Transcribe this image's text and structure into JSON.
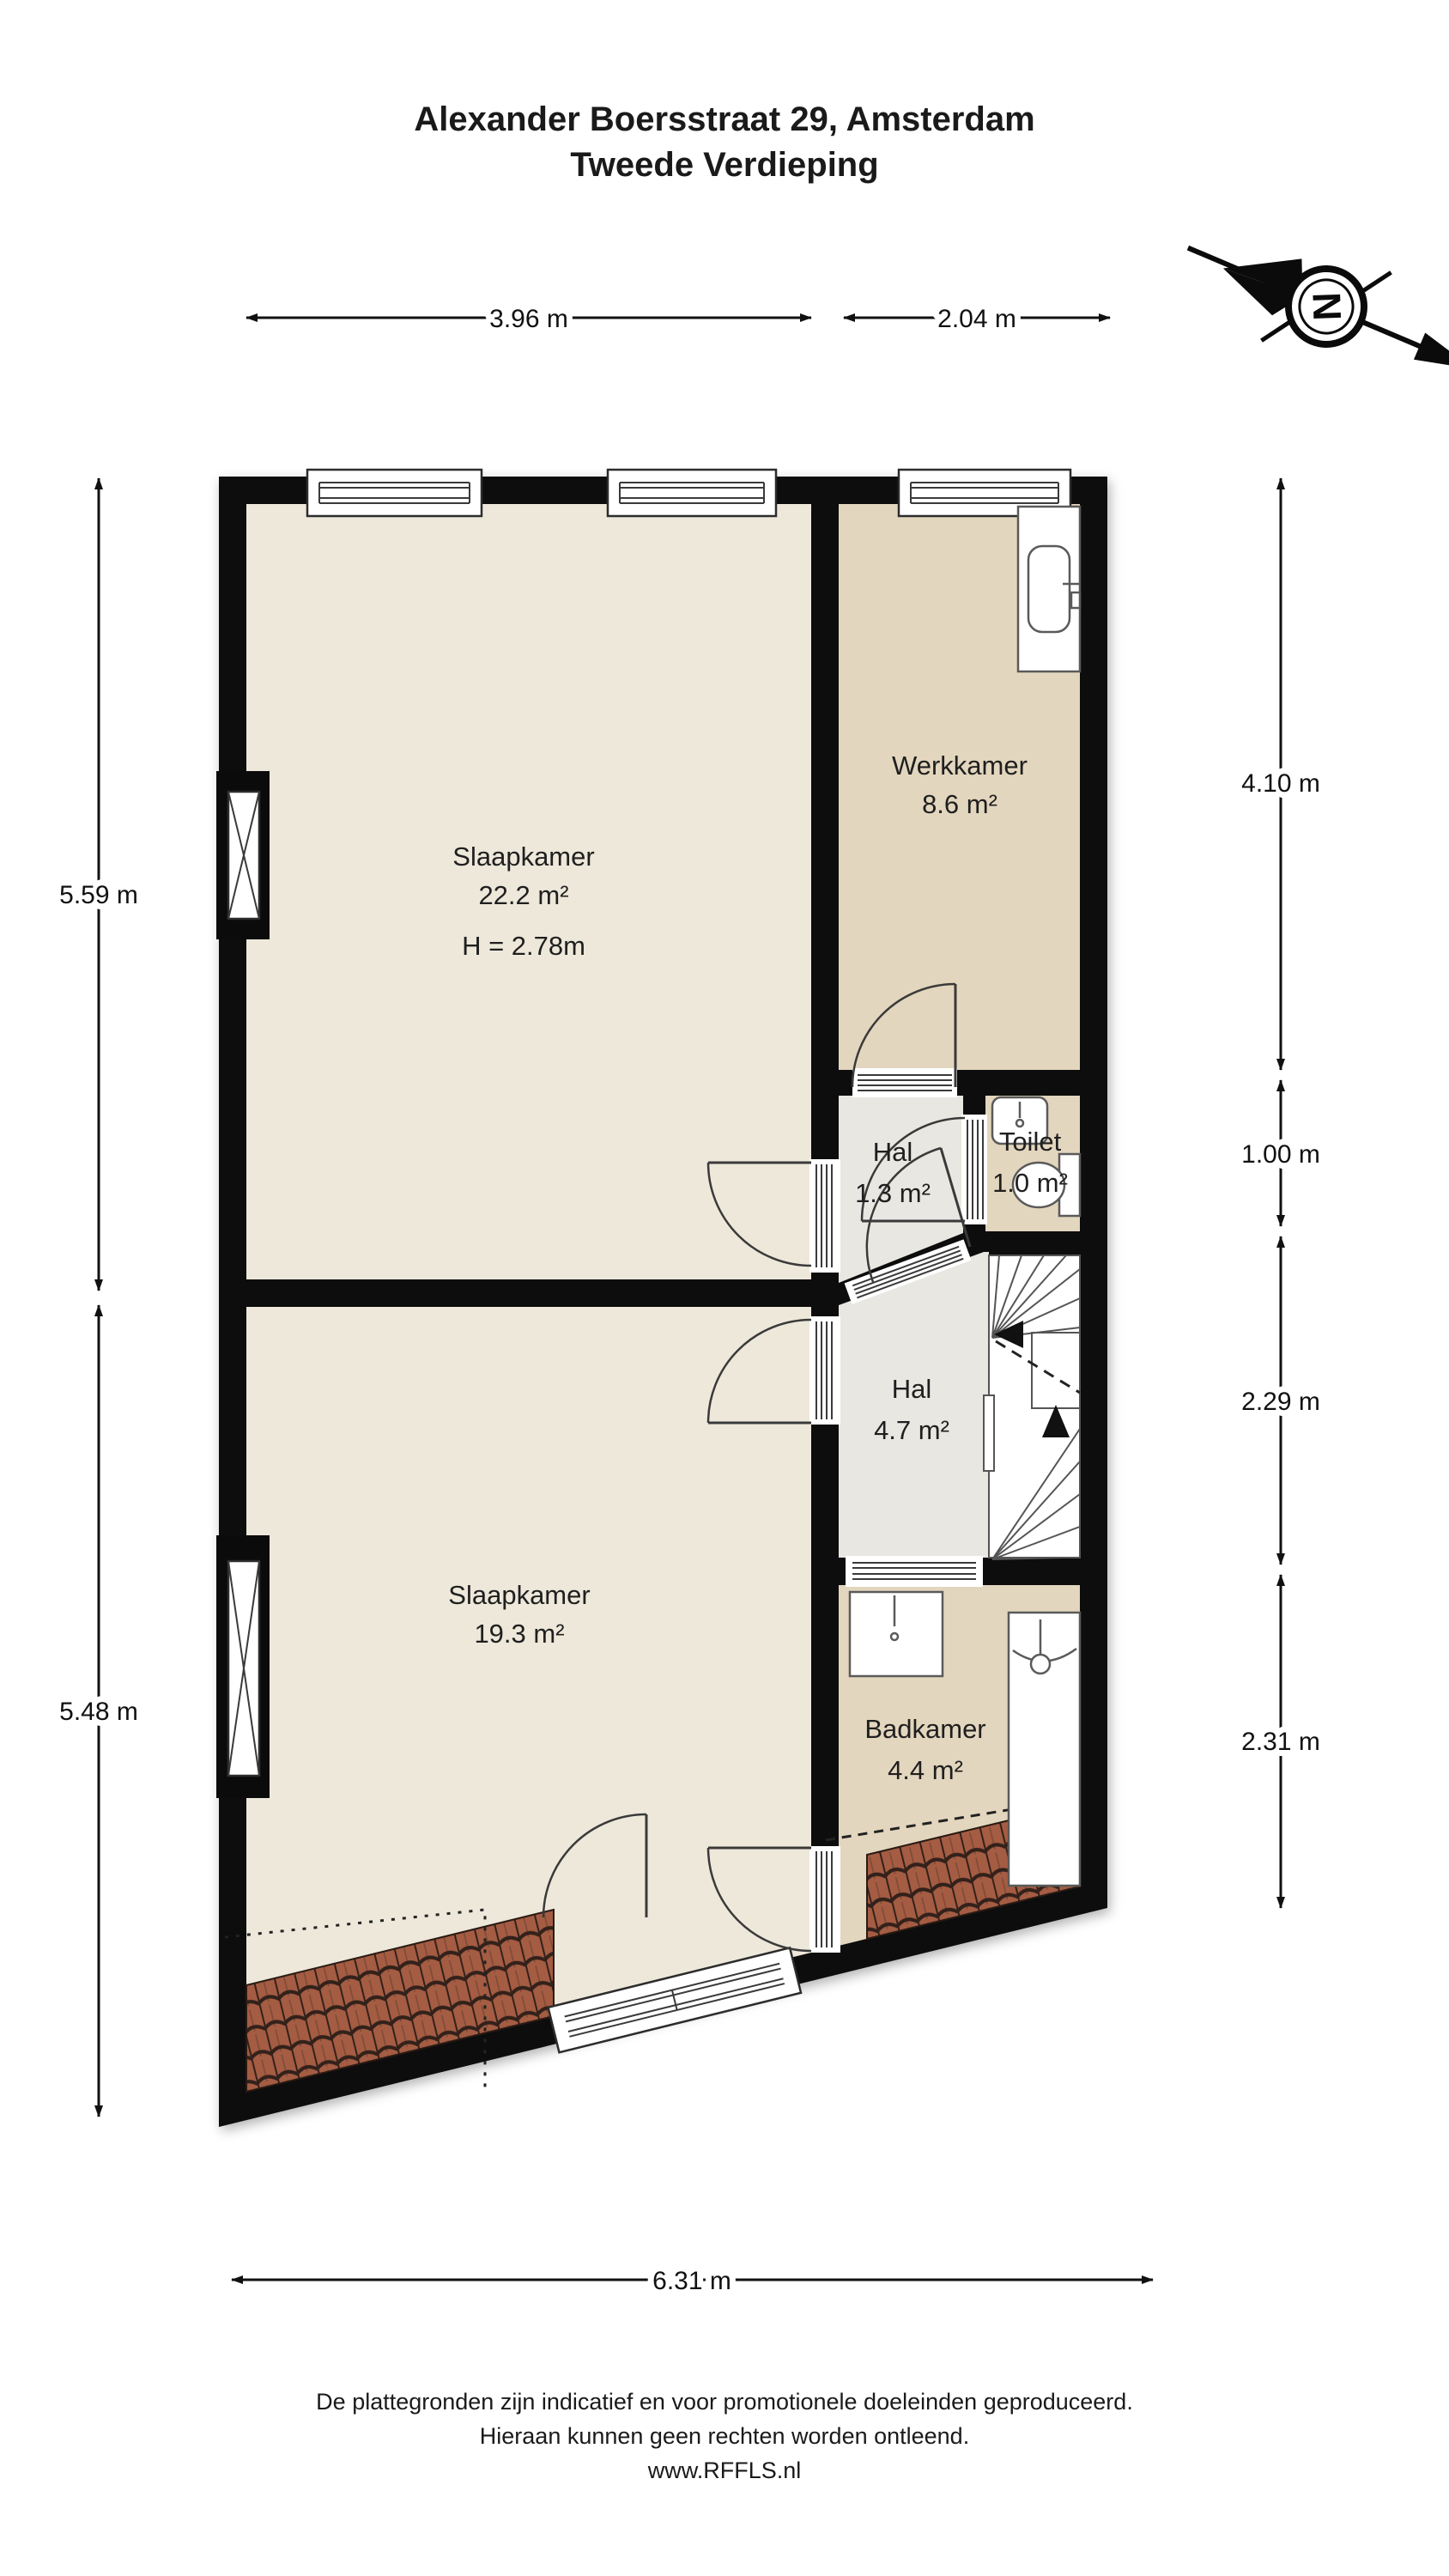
{
  "title": {
    "line1": "Alexander Boersstraat 29, Amsterdam",
    "line2": "Tweede Verdieping"
  },
  "compass": {
    "north_label": "N"
  },
  "dimensions": {
    "top_1": "3.96 m",
    "top_2": "2.04 m",
    "left_1": "5.59 m",
    "left_2": "5.48 m",
    "right_1": "4.10 m",
    "right_2": "1.00 m",
    "right_3": "2.29 m",
    "right_4": "2.31 m",
    "bottom_1": "6.31 m"
  },
  "rooms": {
    "slaapkamer_boven": {
      "name": "Slaapkamer",
      "area": "22.2 m²",
      "ceiling": "H = 2.78m"
    },
    "werkkamer": {
      "name": "Werkkamer",
      "area": "8.6 m²"
    },
    "hal_klein": {
      "name": "Hal",
      "area": "1.3 m²"
    },
    "toilet": {
      "name": "Toilet",
      "area": "1.0 m²"
    },
    "hal_groot": {
      "name": "Hal",
      "area": "4.7 m²"
    },
    "slaapkamer_onder": {
      "name": "Slaapkamer",
      "area": "19.3 m²"
    },
    "badkamer": {
      "name": "Badkamer",
      "area": "4.4 m²"
    }
  },
  "footer": {
    "line1": "De plattegronden zijn indicatief en voor promotionele doeleinden geproduceerd.",
    "line2": "Hieraan kunnen geen rechten worden ontleend.",
    "line3": "www.RFFLS.nl"
  },
  "colors": {
    "wall": "#0b0b0b",
    "floor_cream": "#ede8da",
    "floor_tan": "#e3d6be",
    "floor_gray": "#e9e7e1",
    "stairs": "#ffffff",
    "roof_tile": "#a45c43",
    "roof_tile_dark": "#33211a",
    "dimension": "#111111"
  }
}
